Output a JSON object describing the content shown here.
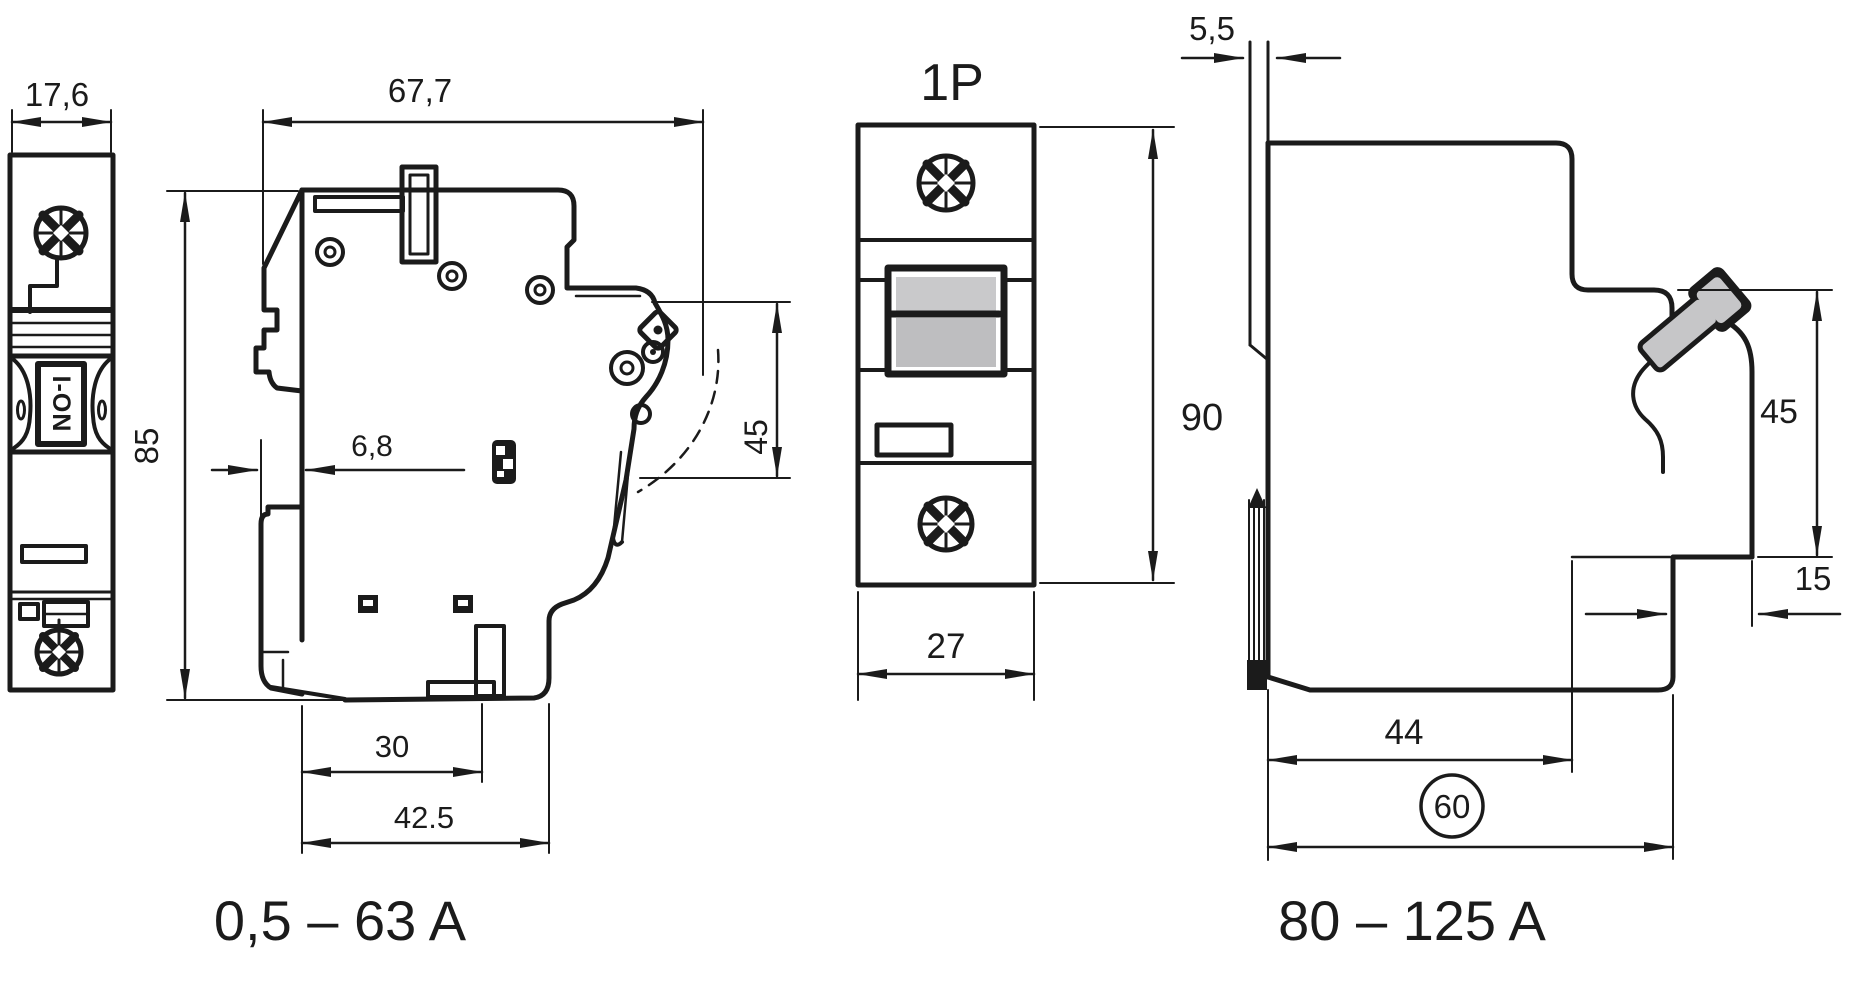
{
  "drawing": {
    "type": "technical-dimension-drawing",
    "views": {
      "front_small": {
        "dims": {
          "width": "17,6"
        },
        "toggle_label": "I-ON"
      },
      "side_small": {
        "dims": {
          "depth": "67,7",
          "height": "85",
          "clip_offset": "6,8",
          "handle_height": "45",
          "slot_depth": "30",
          "base_depth": "42.5"
        },
        "range_label": "0,5 – 63 A"
      },
      "front_1p": {
        "title": "1P",
        "dims": {
          "height": "90",
          "width": "27"
        }
      },
      "side_large": {
        "dims": {
          "panel_thickness": "5,5",
          "front_height": "45",
          "terminal_depth": "15",
          "base_depth": "44",
          "total_depth": "60"
        },
        "range_label": "80 – 125 A"
      }
    },
    "colors": {
      "line": "#1b1b1b",
      "background": "#ffffff",
      "toggle_gray_light": "#c9c9cb",
      "toggle_gray_dark": "#bebec0",
      "handle_gray": "#c6c6c8"
    }
  }
}
